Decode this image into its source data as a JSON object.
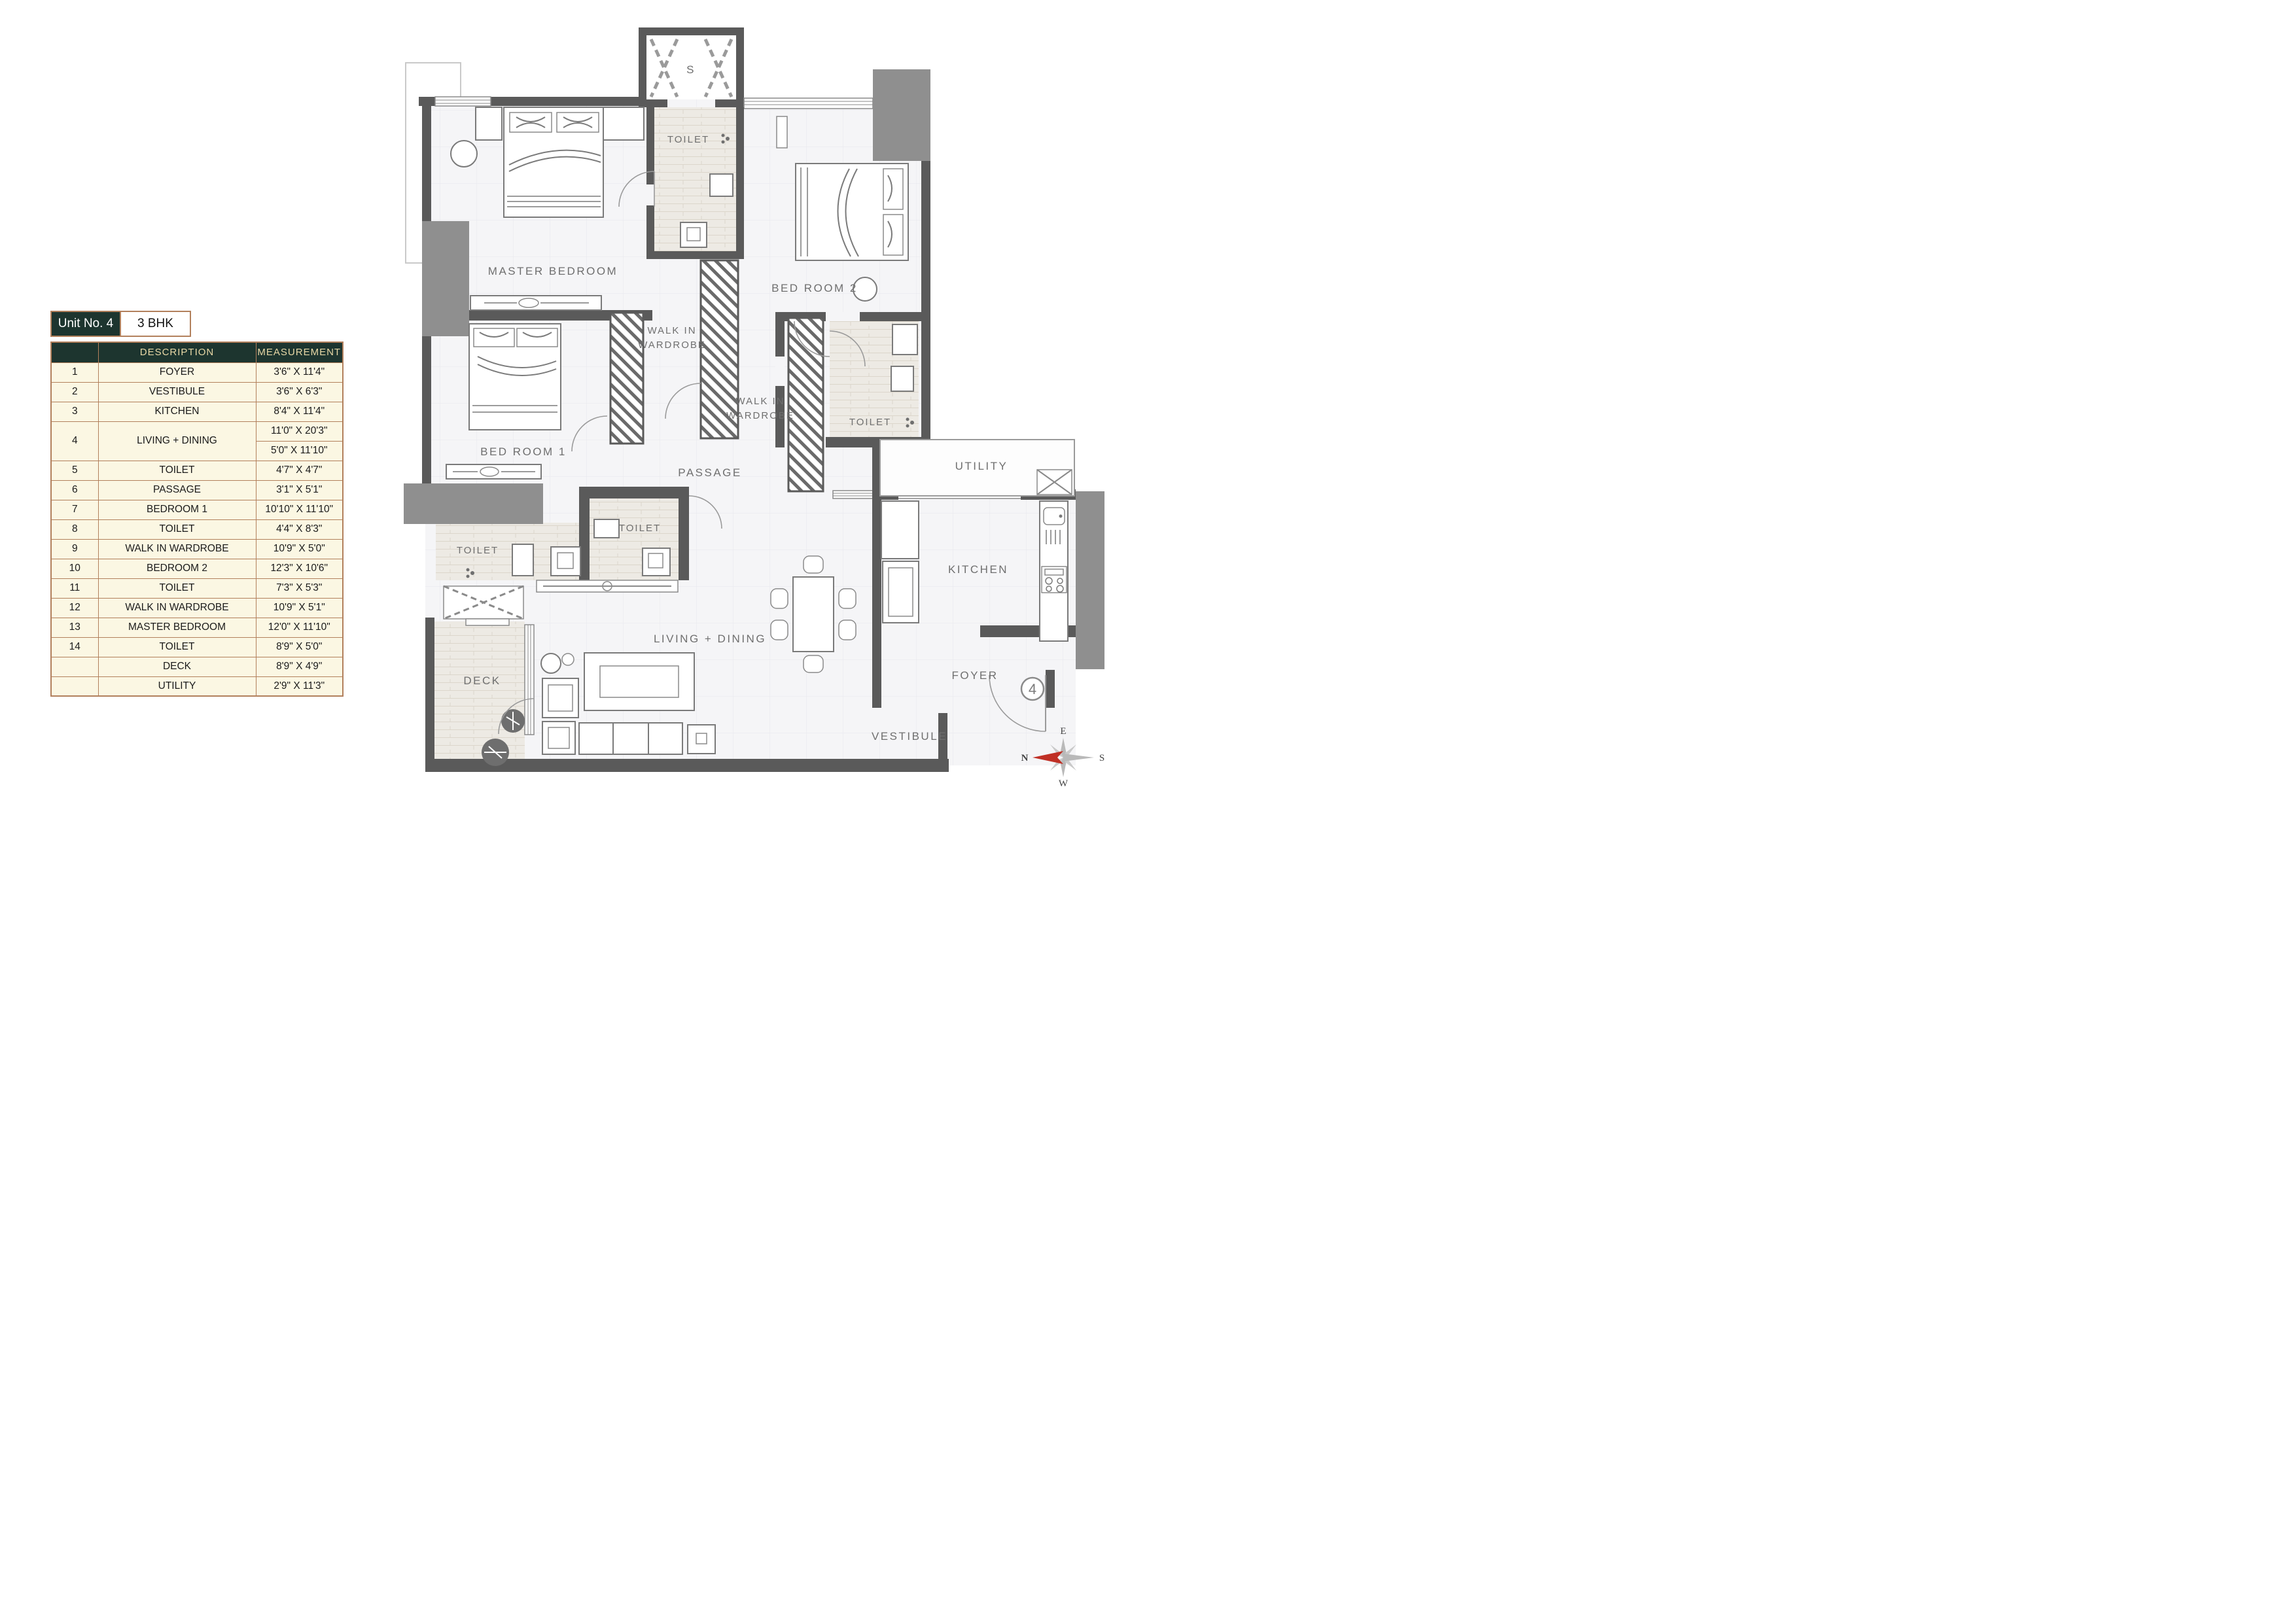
{
  "unit_info": {
    "unit_label": "Unit No. 4",
    "bhk_label": "3 BHK"
  },
  "table": {
    "headers": {
      "number": "",
      "description": "DESCRIPTION",
      "measurement": "MEASUREMENT"
    },
    "rows": [
      {
        "no": "1",
        "description": "FOYER",
        "measurement": "3'6\" X 11'4\""
      },
      {
        "no": "2",
        "description": "VESTIBULE",
        "measurement": "3'6\" X 6'3\""
      },
      {
        "no": "3",
        "description": "KITCHEN",
        "measurement": "8'4\" X 11'4\""
      },
      {
        "no": "4",
        "description": "LIVING + DINING",
        "measurement_1": "11'0\" X 20'3\"",
        "measurement_2": "5'0\" X 11'10\""
      },
      {
        "no": "5",
        "description": "TOILET",
        "measurement": "4'7\" X 4'7\""
      },
      {
        "no": "6",
        "description": "PASSAGE",
        "measurement": "3'1\" X 5'1\""
      },
      {
        "no": "7",
        "description": "BEDROOM 1",
        "measurement": "10'10\" X 11'10\""
      },
      {
        "no": "8",
        "description": "TOILET",
        "measurement": "4'4\" X 8'3\""
      },
      {
        "no": "9",
        "description": "WALK IN WARDROBE",
        "measurement": "10'9\" X 5'0\""
      },
      {
        "no": "10",
        "description": "BEDROOM 2",
        "measurement": "12'3\" X 10'6\""
      },
      {
        "no": "11",
        "description": "TOILET",
        "measurement": "7'3\" X 5'3\""
      },
      {
        "no": "12",
        "description": "WALK IN WARDROBE",
        "measurement": "10'9\" X 5'1\""
      },
      {
        "no": "13",
        "description": "MASTER BEDROOM",
        "measurement": "12'0\" X 11'10\""
      },
      {
        "no": "14",
        "description": "TOILET",
        "measurement": "8'9\" X 5'0\""
      },
      {
        "no": "",
        "description": "DECK",
        "measurement": "8'9\" X 4'9\""
      },
      {
        "no": "",
        "description": "UTILITY",
        "measurement": "2'9\" X 11'3\""
      }
    ]
  },
  "plan": {
    "shaft": "S",
    "toilet_master": "TOILET",
    "master_bedroom": "MASTER BEDROOM",
    "bed_room_2": "BED ROOM 2",
    "walk_in_1_line1": "WALK IN",
    "walk_in_1_line2": "WARDROBE",
    "walk_in_2_line1": "WALK IN",
    "walk_in_2_line2": "WARDROBE",
    "toilet_bed2": "TOILET",
    "utility": "UTILITY",
    "bed_room_1": "BED ROOM 1",
    "passage": "PASSAGE",
    "toilet_bed1": "TOILET",
    "toilet_common": "TOILET",
    "kitchen": "KITCHEN",
    "living_dining": "LIVING + DINING",
    "deck": "DECK",
    "foyer": "FOYER",
    "vestibule": "VESTIBULE",
    "unit_circle_number": "4",
    "compass": {
      "n": "N",
      "e": "E",
      "s": "S",
      "w": "W"
    }
  },
  "colors": {
    "header_green": "#1d352f",
    "header_gold": "#e8d8a6",
    "row_cream": "#fbf7e3",
    "border_tan": "#b2805c",
    "wall_gray": "#5a5a5a",
    "block_gray": "#8f8f8f",
    "label_gray": "#6f6f6f",
    "compass_red": "#c03026"
  }
}
